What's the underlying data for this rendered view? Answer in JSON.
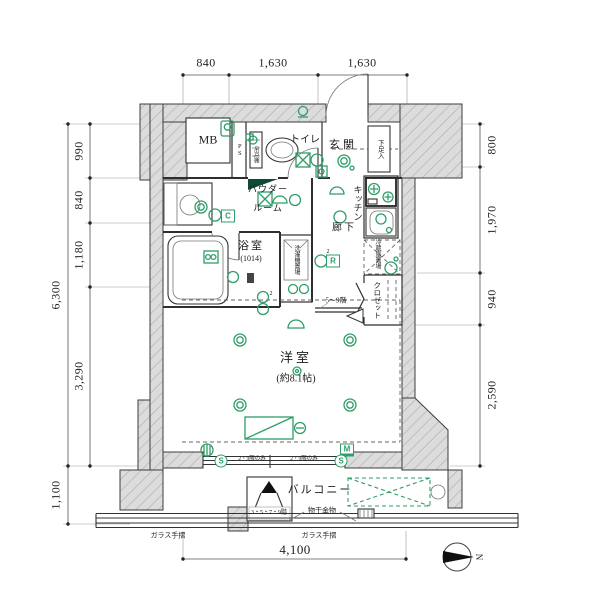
{
  "meta": {
    "type": "apartment-floor-plan",
    "compass_points": "right"
  },
  "colors": {
    "symbol_green": "#2f9e68",
    "wall_gray": "#dcdcdc",
    "line_dark": "#3d3d3d"
  },
  "dimensions_summary": {
    "top": [
      "840",
      "1,630",
      "1,630"
    ],
    "left_total": "6,300",
    "left": [
      "990",
      "840",
      "1,180",
      "3,290"
    ],
    "left_balcony": "1,100",
    "right": [
      "800",
      "1,970",
      "940",
      "2,590"
    ],
    "bottom": "4,100"
  },
  "labels": {
    "dimensions": [
      {
        "id": "dim-top-840",
        "text": "840",
        "x": 206,
        "y": 63,
        "s": 12,
        "cls": "dim"
      },
      {
        "id": "dim-top-1630a",
        "text": "1,630",
        "x": 273,
        "y": 63,
        "s": 12,
        "cls": "dim"
      },
      {
        "id": "dim-top-1630b",
        "text": "1,630",
        "x": 362,
        "y": 63,
        "s": 12,
        "cls": "dim"
      },
      {
        "id": "dim-left-6300",
        "text": "6,300",
        "x": 56,
        "y": 295,
        "s": 12,
        "cls": "dim rot"
      },
      {
        "id": "dim-left-990",
        "text": "990",
        "x": 79,
        "y": 151,
        "s": 12,
        "cls": "dim rot"
      },
      {
        "id": "dim-left-840",
        "text": "840",
        "x": 79,
        "y": 200,
        "s": 12,
        "cls": "dim rot"
      },
      {
        "id": "dim-left-1180",
        "text": "1,180",
        "x": 79,
        "y": 255,
        "s": 12,
        "cls": "dim rot"
      },
      {
        "id": "dim-left-3290",
        "text": "3,290",
        "x": 79,
        "y": 376,
        "s": 12,
        "cls": "dim rot"
      },
      {
        "id": "dim-left-1100",
        "text": "1,100",
        "x": 56,
        "y": 495,
        "s": 12,
        "cls": "dim rot"
      },
      {
        "id": "dim-right-800",
        "text": "800",
        "x": 492,
        "y": 145,
        "s": 12,
        "cls": "dim rot"
      },
      {
        "id": "dim-right-1970",
        "text": "1,970",
        "x": 492,
        "y": 220,
        "s": 12,
        "cls": "dim rot"
      },
      {
        "id": "dim-right-940",
        "text": "940",
        "x": 492,
        "y": 299,
        "s": 12,
        "cls": "dim rot"
      },
      {
        "id": "dim-right-2590",
        "text": "2,590",
        "x": 492,
        "y": 395,
        "s": 12,
        "cls": "dim rot"
      },
      {
        "id": "dim-bottom-4100",
        "text": "4,100",
        "x": 295,
        "y": 550,
        "s": 13,
        "cls": "dim"
      }
    ],
    "rooms": [
      {
        "id": "room-mb",
        "text": "MB",
        "x": 208,
        "y": 140,
        "s": 12
      },
      {
        "id": "room-ps",
        "text": "PS",
        "x": 239,
        "y": 150,
        "s": 6.5,
        "cls": "v"
      },
      {
        "id": "room-toilet",
        "text": "トイレ",
        "x": 305,
        "y": 141,
        "s": 10
      },
      {
        "id": "room-genkan",
        "text": "玄関",
        "x": 343,
        "y": 146,
        "s": 11,
        "ls": 3
      },
      {
        "id": "room-shoebox",
        "text": "下足入",
        "x": 379,
        "y": 149,
        "s": 6.5,
        "cls": "v"
      },
      {
        "id": "room-powder-1",
        "text": "パウダー",
        "x": 268,
        "y": 190,
        "s": 9,
        "ls": 1
      },
      {
        "id": "room-powder-2",
        "text": "ルーム",
        "x": 268,
        "y": 209,
        "s": 9,
        "ls": 1
      },
      {
        "id": "room-kitchen",
        "text": "キッチン",
        "x": 357,
        "y": 203,
        "s": 9,
        "cls": "v"
      },
      {
        "id": "room-corridor",
        "text": "廊下",
        "x": 344,
        "y": 229,
        "s": 10,
        "ls": 2
      },
      {
        "id": "room-bath",
        "text": "浴室",
        "x": 251,
        "y": 247,
        "s": 11,
        "ls": 2
      },
      {
        "id": "room-bath-size",
        "text": "(1014)",
        "x": 251,
        "y": 259,
        "s": 8
      },
      {
        "id": "room-washer",
        "text": "洗濯機置場",
        "x": 296,
        "y": 260,
        "s": 6,
        "cls": "v"
      },
      {
        "id": "room-fridge",
        "text": "冷蔵庫置場",
        "x": 377,
        "y": 254,
        "s": 6,
        "cls": "v"
      },
      {
        "id": "room-closet",
        "text": "クロゼット",
        "x": 377,
        "y": 300,
        "s": 7.5,
        "cls": "v"
      },
      {
        "id": "room-western",
        "text": "洋室",
        "x": 296,
        "y": 358,
        "s": 13,
        "ls": 3
      },
      {
        "id": "room-western-size",
        "text": "(約8.1帖)",
        "x": 296,
        "y": 380,
        "s": 10
      },
      {
        "id": "room-balcony",
        "text": "バルコニー",
        "x": 320,
        "y": 491,
        "s": 11,
        "ls": 2
      },
      {
        "id": "room-cupboard",
        "text": "吊戸棚",
        "x": 255,
        "y": 155,
        "s": 5.5,
        "cls": "v"
      }
    ],
    "notes": [
      {
        "id": "note-monohoshi",
        "text": "物干金物",
        "x": 322,
        "y": 511,
        "s": 7
      },
      {
        "id": "note-glassrail-left",
        "text": "ガラス手摺",
        "x": 168,
        "y": 536,
        "s": 7
      },
      {
        "id": "note-glassrail-right",
        "text": "ガラス手摺",
        "x": 319,
        "y": 536,
        "s": 7
      },
      {
        "id": "note-hatch-floors",
        "text": "3・5・7・9階",
        "x": 269,
        "y": 513,
        "s": 6
      },
      {
        "id": "note-floors-5-9",
        "text": "5〜9階",
        "x": 336,
        "y": 301,
        "s": 7
      },
      {
        "id": "note-window-floors-a",
        "text": "2・9階のみ",
        "x": 252,
        "y": 460,
        "s": 5.5
      },
      {
        "id": "note-window-floors-b",
        "text": "2・9階のみ",
        "x": 304,
        "y": 460,
        "s": 5.5
      },
      {
        "id": "note-circuit-2a",
        "text": "2",
        "x": 328,
        "y": 252,
        "s": 6
      },
      {
        "id": "note-circuit-2b",
        "text": "2",
        "x": 271,
        "y": 294,
        "s": 6
      }
    ],
    "badges": [
      {
        "id": "badge-c",
        "text": "C",
        "x": 228,
        "y": 216,
        "cls": "badge"
      },
      {
        "id": "badge-r",
        "text": "R",
        "x": 333,
        "y": 261,
        "cls": "badge"
      },
      {
        "id": "badge-m",
        "text": "M",
        "x": 347,
        "y": 450,
        "cls": "badge m"
      },
      {
        "id": "badge-s-left",
        "text": "S",
        "x": 221,
        "y": 461,
        "cls": "scirc"
      },
      {
        "id": "badge-s-right",
        "text": "S",
        "x": 341,
        "y": 461,
        "cls": "scirc"
      }
    ],
    "compass": [
      {
        "id": "compass-n-label",
        "text": "N",
        "x": 478,
        "y": 557,
        "s": 9,
        "cls": "rot90"
      }
    ]
  }
}
